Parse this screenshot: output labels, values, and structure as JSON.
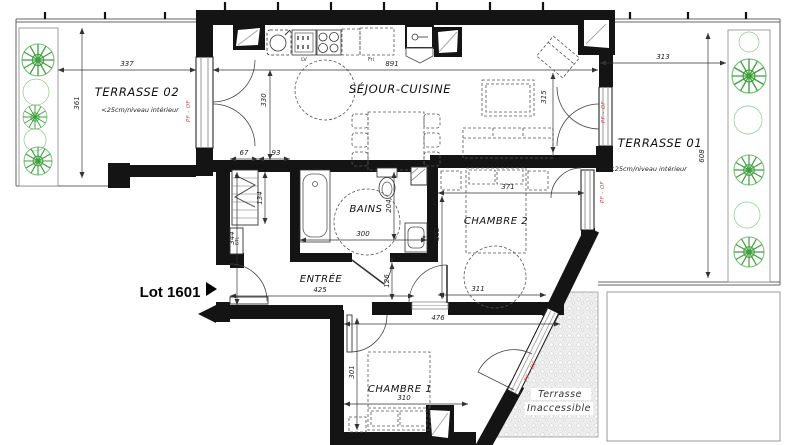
{
  "plan": {
    "lot_label": "Lot 1601",
    "rooms": {
      "terrasse02": {
        "name": "TERRASSE 02",
        "note": "<25cm/niveau intérieur"
      },
      "sejour": {
        "name": "SÉJOUR-CUISINE"
      },
      "terrasse01": {
        "name": "TERRASSE 01",
        "note": "<25cm/niveau intérieur"
      },
      "bains": {
        "name": "BAINS"
      },
      "entree": {
        "name": "ENTRÉE"
      },
      "chambre2": {
        "name": "CHAMBRE 2"
      },
      "chambre1": {
        "name": "CHAMBRE 1"
      },
      "terrasse_inaccessible": {
        "line1": "Terrasse",
        "line2": "Inaccessible"
      }
    },
    "dims": {
      "terrasse02_width": "337",
      "terrasse02_height": "361",
      "sejour_width": "891",
      "sejour_height": "330",
      "sejour_east": "315",
      "terrasse01_width": "313",
      "terrasse01_height": "608",
      "bains_width": "300",
      "bains_height": "204",
      "closet_depth": "67",
      "closet_gap": "93",
      "closet_height": "134",
      "entree_height": "344",
      "entree_width": "425",
      "hall_width": "126",
      "chambre2_width": "371",
      "chambre2_height": "352",
      "chambre2_bottom": "311",
      "chambre1_top": "476",
      "chambre1_height": "301",
      "chambre1_width": "310"
    },
    "labels": {
      "window_type": "PF - OF",
      "gtl": "GTL",
      "dishwasher": "LV",
      "fridge": "Fri"
    },
    "colors": {
      "wall": "#141414",
      "red_label": "#c74a4a",
      "plant_green": "#3f9f3f",
      "dim_text": "#222222"
    }
  }
}
